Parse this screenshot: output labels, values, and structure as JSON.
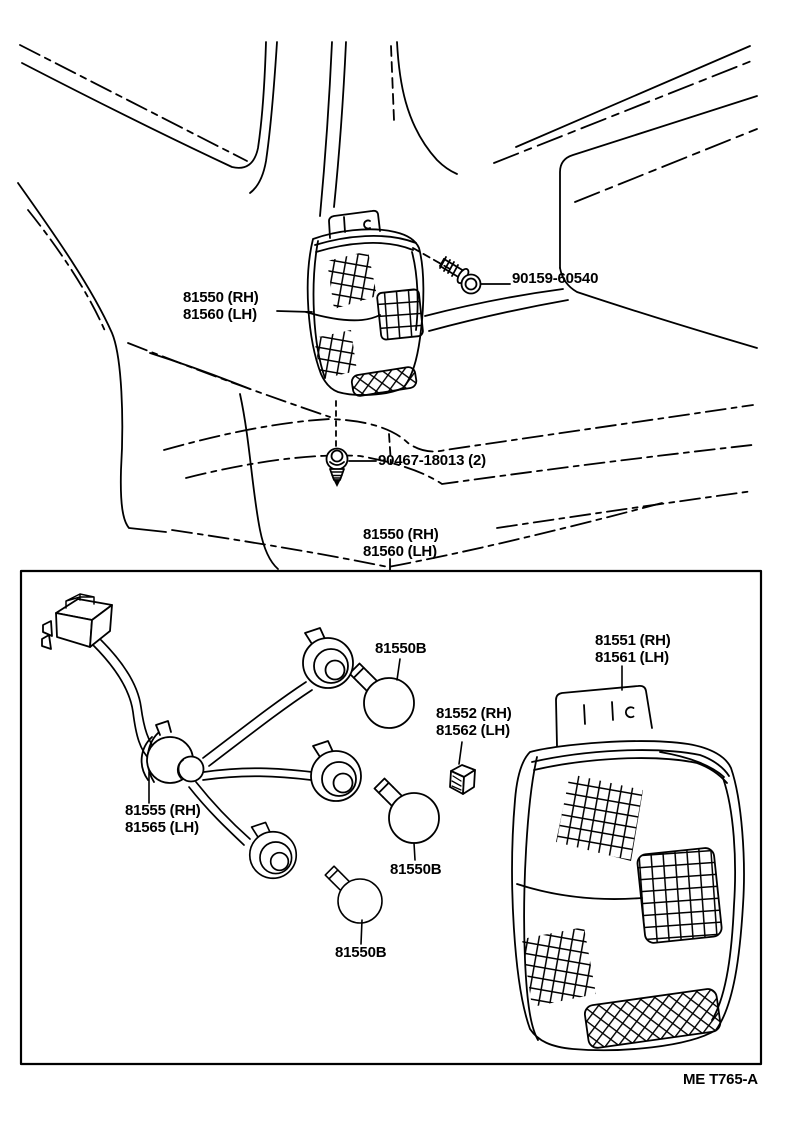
{
  "figure_code": "ME T765-A",
  "colors": {
    "ink": "#000000",
    "paper": "#ffffff"
  },
  "callouts": {
    "lamp_assy": {
      "line1": "81550 (RH)",
      "line2": "81560 (LH)"
    },
    "screw": {
      "label": "90159-60540"
    },
    "clip": {
      "label": "90467-18013 (2)"
    },
    "box_assy": {
      "line1": "81550 (RH)",
      "line2": "81560 (LH)"
    },
    "bulb_top": {
      "label": "81550B"
    },
    "bulb_mid": {
      "label": "81550B"
    },
    "bulb_low": {
      "label": "81550B"
    },
    "lens": {
      "line1": "81551 (RH)",
      "line2": "81561 (LH)"
    },
    "socket": {
      "line1": "81552 (RH)",
      "line2": "81562 (LH)"
    },
    "cord": {
      "line1": "81555 (RH)",
      "line2": "81565 (LH)"
    }
  }
}
